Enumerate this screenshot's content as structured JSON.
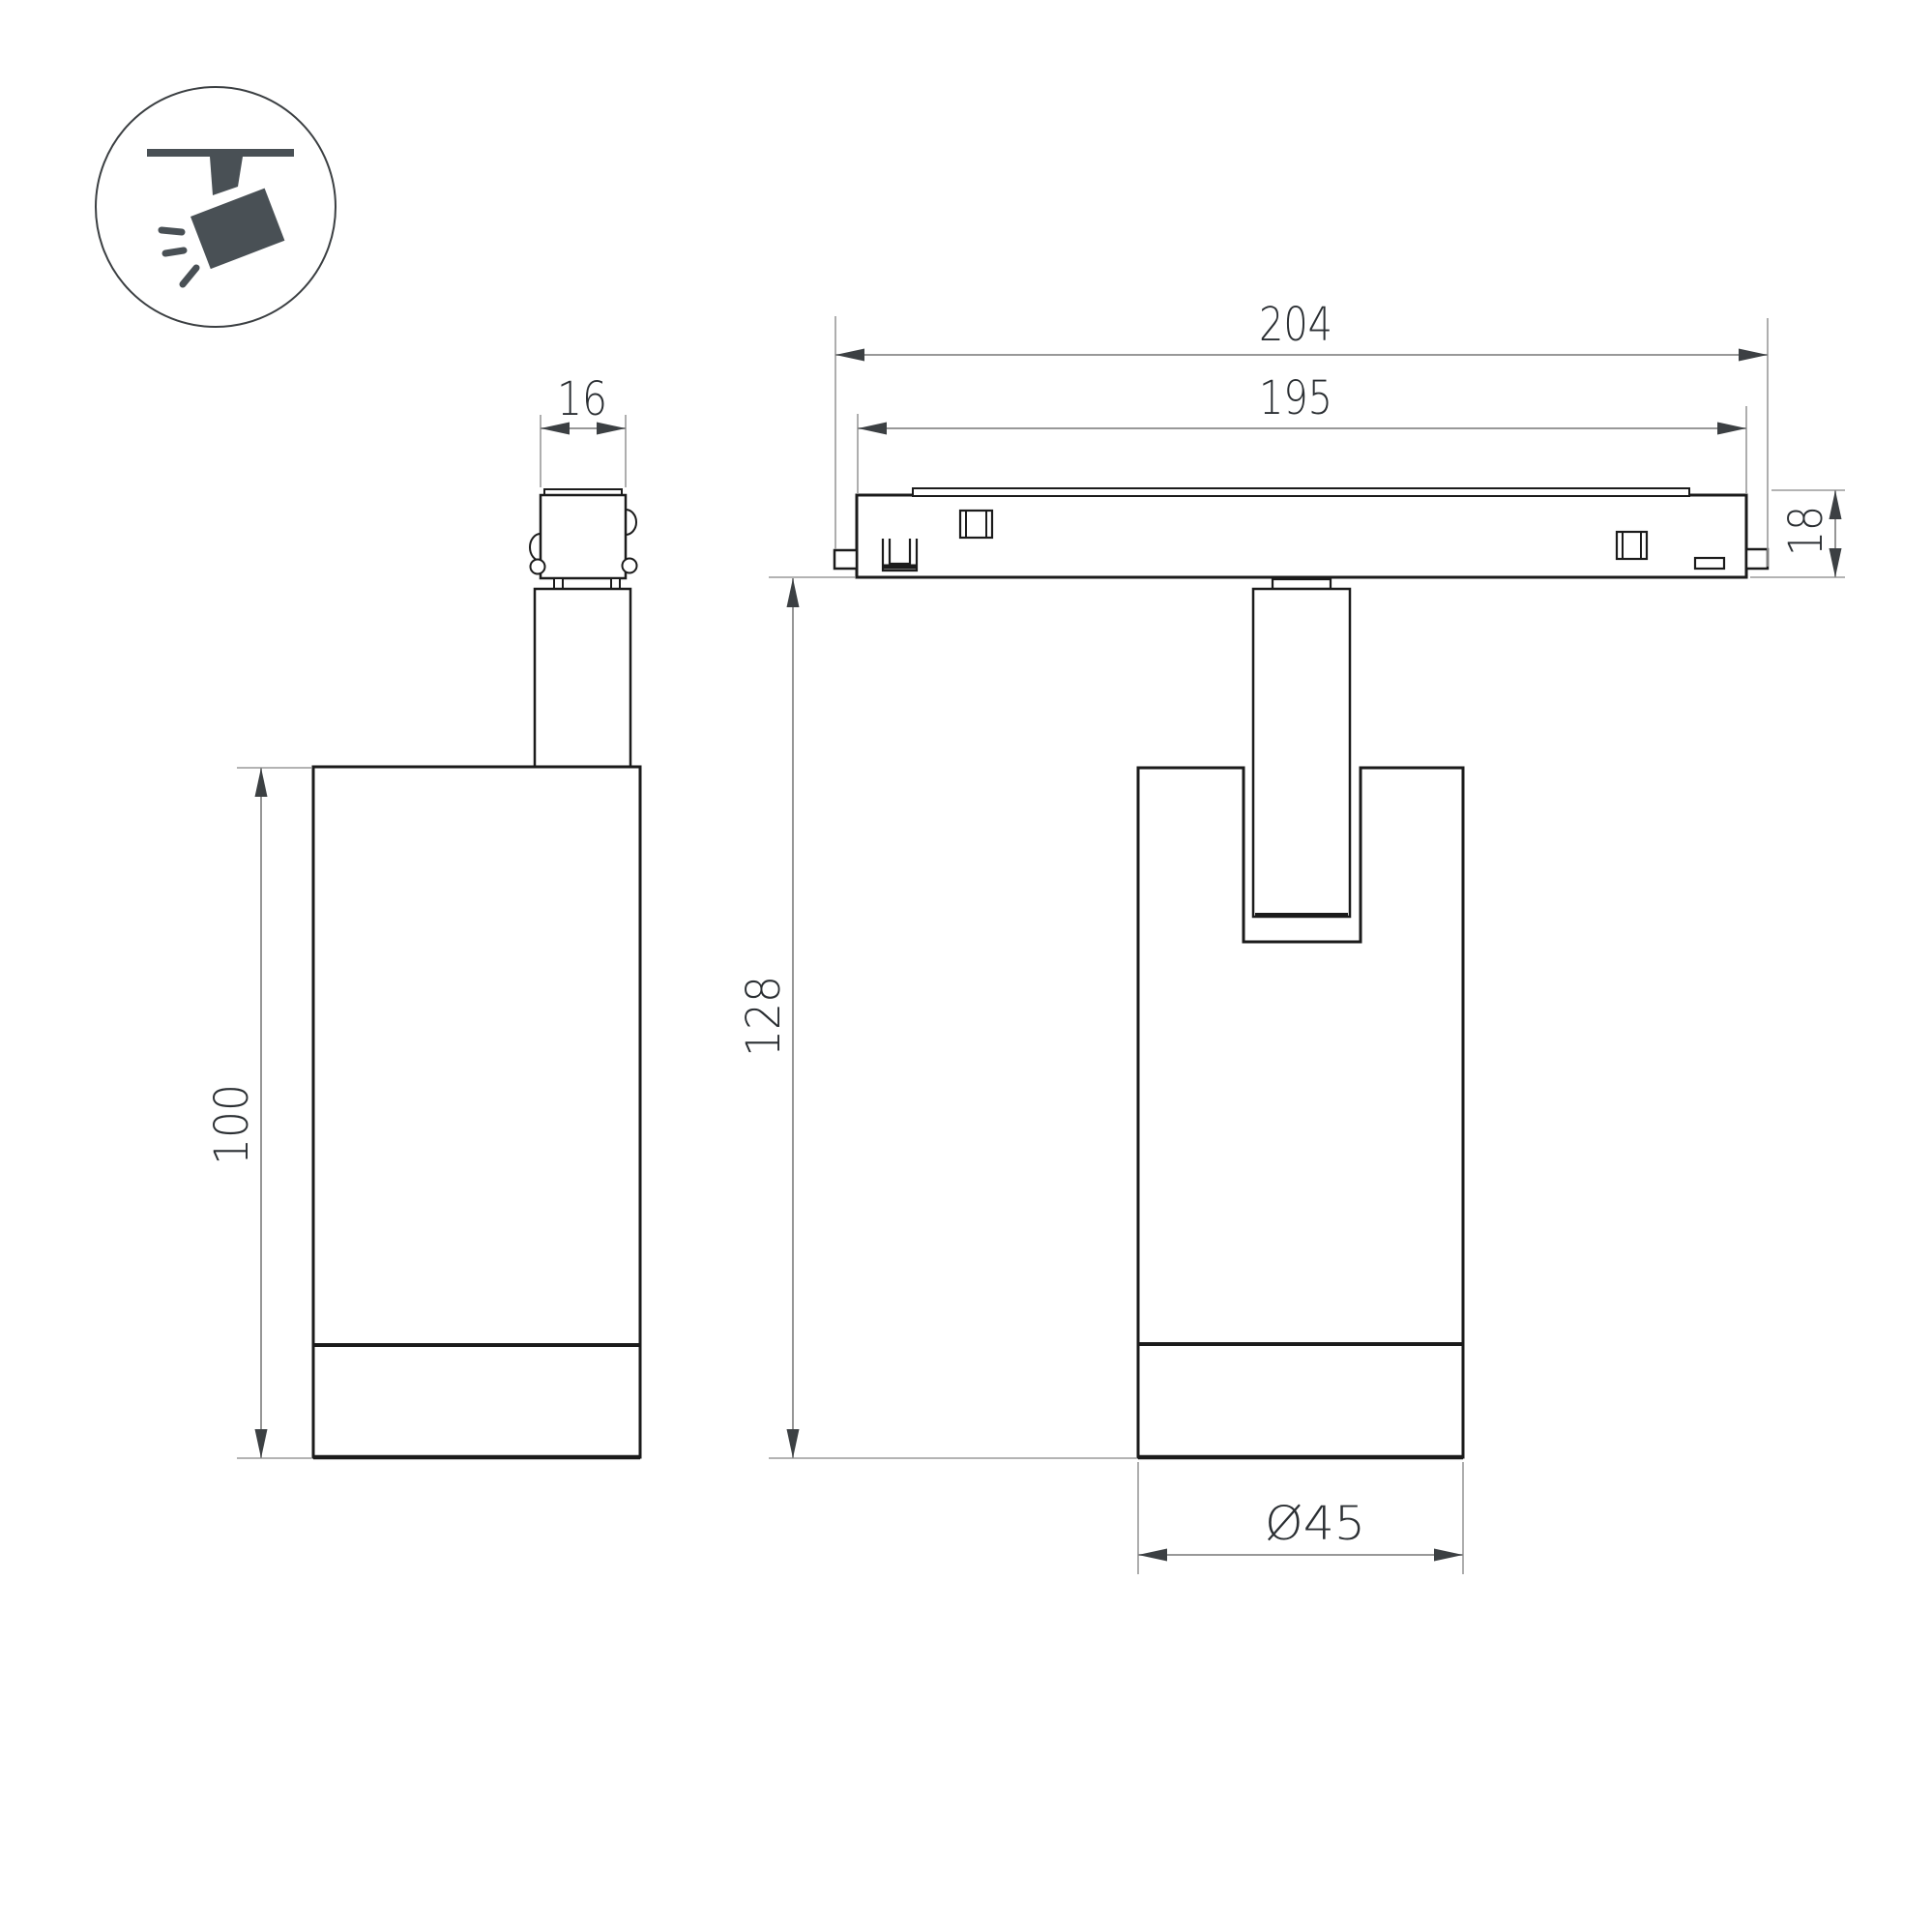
{
  "document": {
    "type": "technical-dimension-drawing",
    "background": "#ffffff"
  },
  "icon": {
    "name": "ceiling-track-spotlight",
    "color": "#495055"
  },
  "colors": {
    "outline": "#1b1b1b",
    "dimension_line": "#8a8a8a",
    "extension_line": "#9a9a9a",
    "arrow": "#3c4043",
    "label_text": "#2b2f33"
  },
  "side_view": {
    "name": "spotlight-side-view",
    "labels": {
      "adapter_width": "16",
      "body_height": "100"
    }
  },
  "front_view": {
    "name": "spotlight-on-track-front-view",
    "labels": {
      "overall_length": "204",
      "rail_length": "195",
      "rail_height": "18",
      "overall_height": "128",
      "body_diameter": "Ø45"
    }
  }
}
